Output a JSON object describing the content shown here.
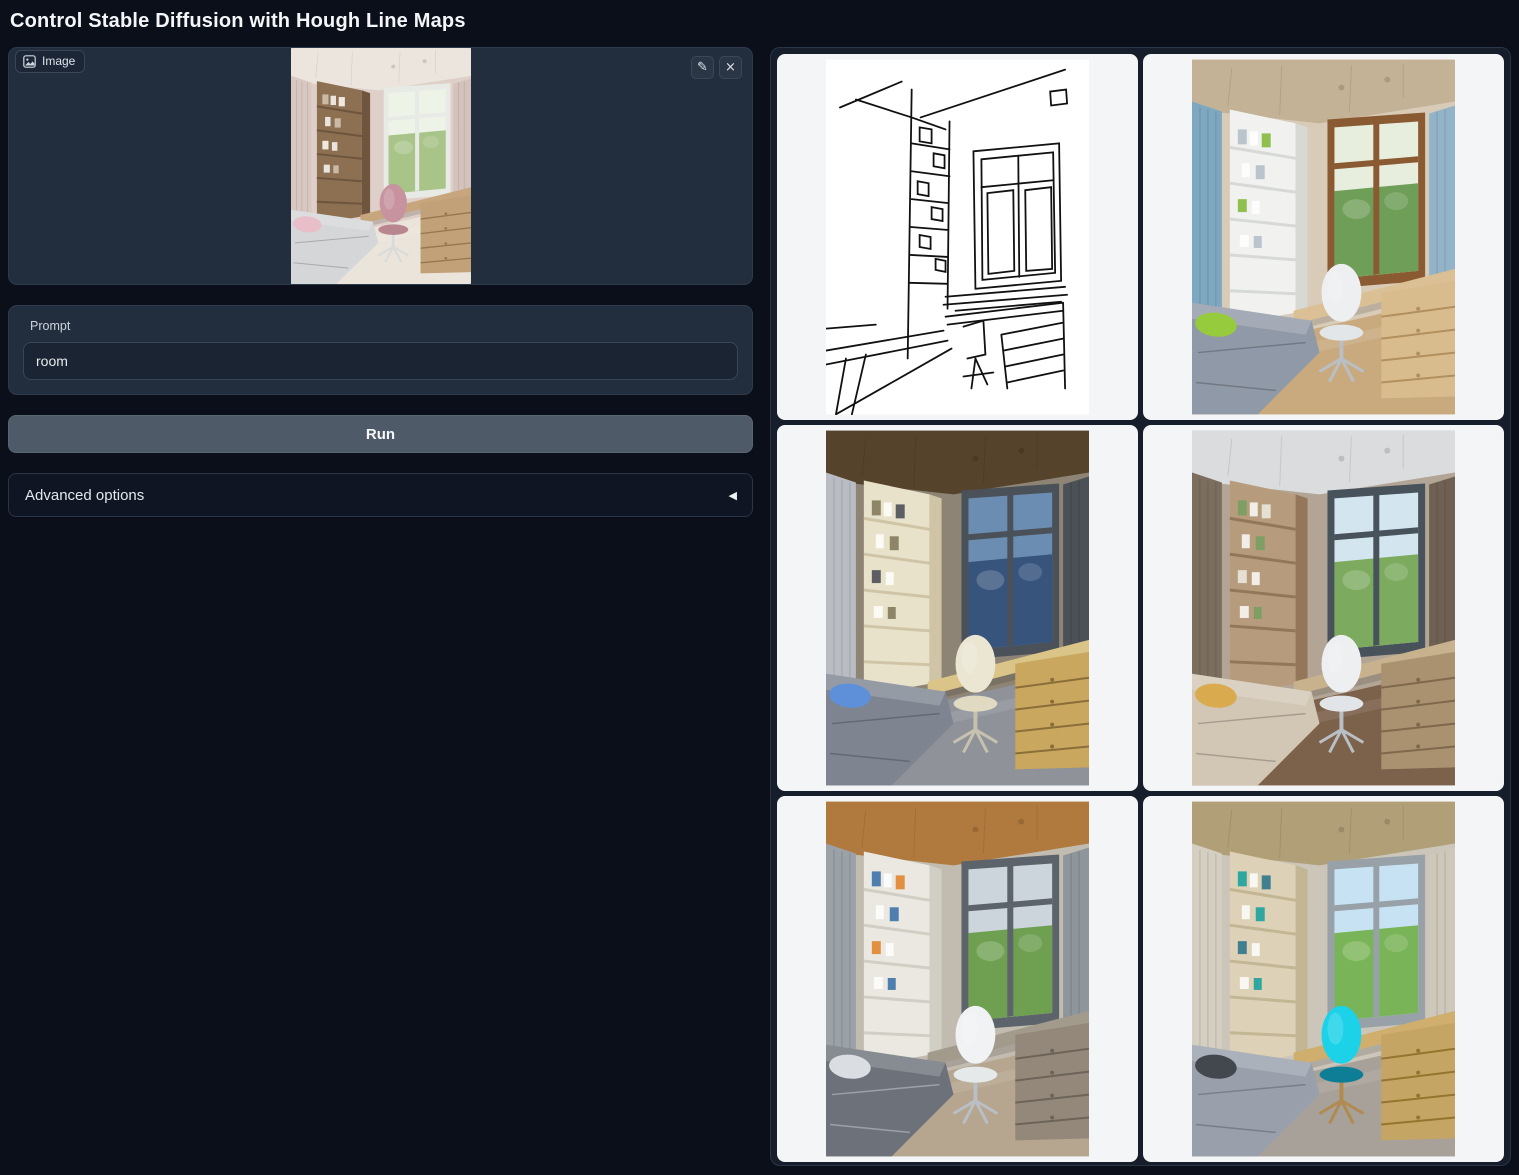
{
  "page": {
    "title": "Control Stable Diffusion with Hough Line Maps",
    "colors": {
      "background": "#0b0f1a",
      "panel": "#222d3d",
      "panel_border": "#2f3b4d",
      "run_button": "#4e5a68",
      "gallery_card": "#f3f5f7",
      "accent_chair_cyan": "#1bd2e9"
    }
  },
  "icons": {
    "edit": "✎",
    "clear": "×",
    "collapse": "◀"
  },
  "image_input": {
    "label": "Image",
    "palette": {
      "wall": "#decfc8",
      "ceiling": "#ebe5dd",
      "curtainL": "#d8c8c1",
      "curtainR": "#d3c3bc",
      "shelf": "#8d6f52",
      "shelfSide": "#6d553e",
      "bookA": "#c9b9a5",
      "bookB": "#efe9e0",
      "frame": "#e8eae6",
      "sky": "#eef3e8",
      "tree": "#a9c489",
      "desk": "#c7a67e",
      "drawer": "#c2a078",
      "drawerLine": "#96774f",
      "chair": "#c6939f",
      "chairSeat": "#b9858f",
      "chairLeg": "#d8dadb",
      "bed": "#d5d6d8",
      "pillow": "#e8bec9",
      "floor": "#eae4da",
      "bedSeam": "#00000035"
    }
  },
  "prompt": {
    "label": "Prompt",
    "value": "room"
  },
  "run_button": {
    "label": "Run"
  },
  "advanced_options": {
    "label": "Advanced options"
  },
  "gallery": {
    "items": [
      {
        "name": "hough-line-map",
        "type": "linemap"
      },
      {
        "name": "generated-room-1",
        "type": "room",
        "palette": {
          "wall": "#d8cbb8",
          "ceiling": "#c4b296",
          "curtainL": "#7ea7c0",
          "curtainR": "#93b4c8",
          "shelf": "#f1f2f0",
          "shelfSide": "#d7d9d5",
          "bookA": "#b9c4cc",
          "bookB": "#8fbf4f",
          "frame": "#8a5a33",
          "sky": "#e8eedd",
          "tree": "#6f9e59",
          "desk": "#dcc095",
          "drawer": "#d9bc8e",
          "drawerLine": "#b1905e",
          "chair": "#edeff0",
          "chairSeat": "#e3e6e8",
          "chairLeg": "#b9bfc4",
          "bed": "#9099a7",
          "pillow": "#97cb3e",
          "floor": "#c9aa7f",
          "bedSeam": "#00000035"
        }
      },
      {
        "name": "generated-room-2",
        "type": "room",
        "palette": {
          "wall": "#8e8476",
          "ceiling": "#56432b",
          "curtainL": "#b9bdc3",
          "curtainR": "#4b5157",
          "shelf": "#e9e2ca",
          "shelfSide": "#cfc5a6",
          "bookA": "#8e8468",
          "bookB": "#5d5e63",
          "frame": "#4a5158",
          "sky": "#6c8db2",
          "tree": "#36547c",
          "desk": "#dbc488",
          "drawer": "#c9a75e",
          "drawerLine": "#8a6e39",
          "chair": "#ebe6d2",
          "chairSeat": "#e0dac2",
          "chairLeg": "#c7c2b0",
          "bed": "#7e8591",
          "pillow": "#5d90d8",
          "floor": "#8f9299",
          "bedSeam": "#00000035"
        }
      },
      {
        "name": "generated-room-3",
        "type": "room",
        "palette": {
          "wall": "#b2a595",
          "ceiling": "#dadcdd",
          "curtainL": "#7c6e5e",
          "curtainR": "#6e6154",
          "shelf": "#b69c7d",
          "shelfSide": "#94775a",
          "bookA": "#7f9e63",
          "bookB": "#e6e0d4",
          "frame": "#47525a",
          "sky": "#d3e5ef",
          "tree": "#7cab5f",
          "desk": "#c8b28d",
          "drawer": "#aa9170",
          "drawerLine": "#7e694d",
          "chair": "#edeff0",
          "chairSeat": "#e2e5e7",
          "chairLeg": "#b9bfc4",
          "bed": "#d2c7b5",
          "pillow": "#d9aa4e",
          "floor": "#7c614b",
          "bedSeam": "#00000035"
        }
      },
      {
        "name": "generated-room-4",
        "type": "room",
        "palette": {
          "wall": "#c2bbb0",
          "ceiling": "#b07a3e",
          "curtainL": "#9aa1a7",
          "curtainR": "#8e959b",
          "shelf": "#eae8e0",
          "shelfSide": "#d1cec5",
          "bookA": "#4f7fae",
          "bookB": "#e2903f",
          "frame": "#5c636a",
          "sky": "#cbd5db",
          "tree": "#6fa052",
          "desk": "#a29a8b",
          "drawer": "#93887a",
          "drawerLine": "#6d6459",
          "chair": "#f0f2f3",
          "chairSeat": "#e6e9ea",
          "chairLeg": "#b9bfc4",
          "bed": "#6d727a",
          "pillow": "#dadde1",
          "floor": "#b6a68f",
          "bedSeam": "#ffffff55"
        }
      },
      {
        "name": "generated-room-5",
        "type": "room",
        "palette": {
          "wall": "#ccc6ba",
          "ceiling": "#b1a077",
          "curtainL": "#d5cfc1",
          "curtainR": "#cec8ba",
          "shelf": "#ddd2b7",
          "shelfSide": "#c3b694",
          "bookA": "#2fa7a0",
          "bookB": "#3f7f8f",
          "frame": "#98a1a8",
          "sky": "#c7e3f3",
          "tree": "#7ab458",
          "desk": "#cfae6e",
          "drawer": "#c5a564",
          "drawerLine": "#93752e",
          "chair": "#1bd2e9",
          "chairSeat": "#0e7e96",
          "chairLeg": "#b08a4f",
          "bed": "#99a0ab",
          "pillow": "#43474e",
          "floor": "#a7a199",
          "bedSeam": "#00000035"
        }
      }
    ]
  }
}
